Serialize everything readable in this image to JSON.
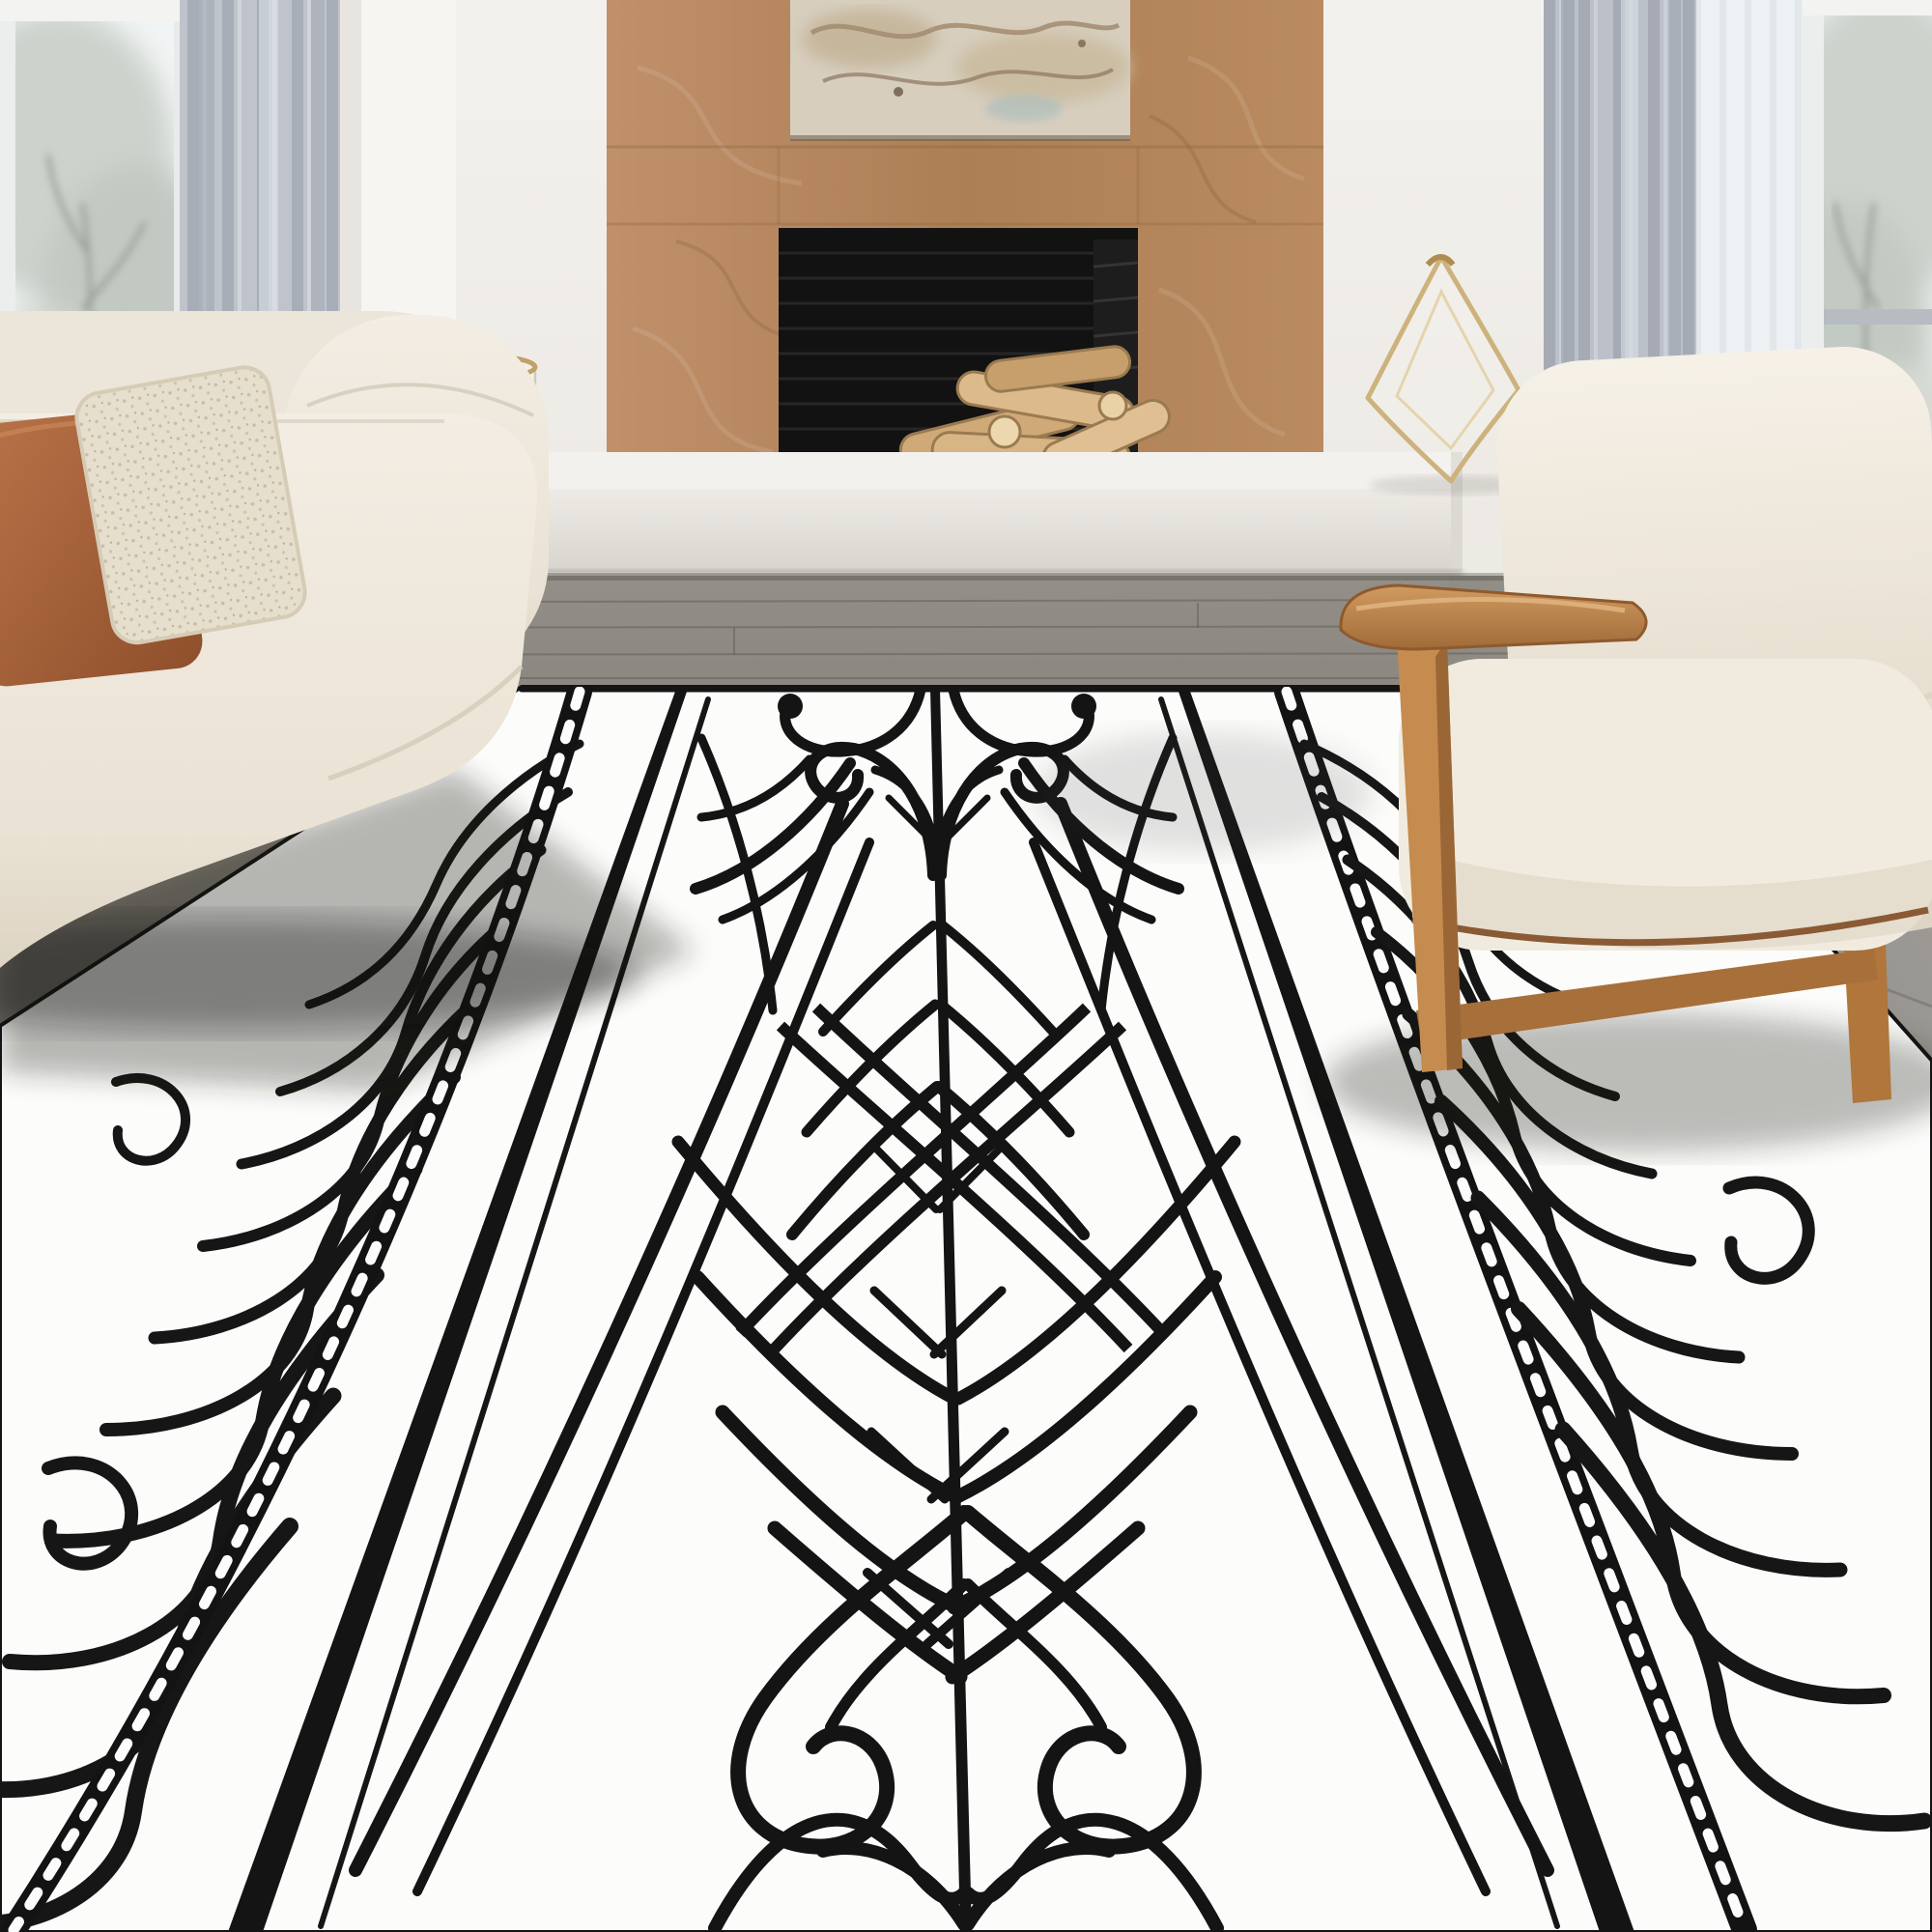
{
  "scene": {
    "type": "interior-photo",
    "setting": "Minimalist living room with fireplace; a large white rug with bold black tribal koru line-art pattern lies on a grey wood floor",
    "objects": {
      "wall": {
        "label": "warm white wall",
        "color": "#edeae4"
      },
      "left_window": {
        "label": "tall left window with winter trees outside",
        "glass": "#f1f4f4",
        "sash": "#b6bcc2"
      },
      "right_window": {
        "label": "tall right window with winter trees outside",
        "glass": "#f1f4f4",
        "sash": "#b6bcc2"
      },
      "left_curtain": {
        "label": "grey curtain panel left",
        "color": "#b9bfc7"
      },
      "right_curtain": {
        "label": "grey curtain panel right",
        "color": "#b9bfc7"
      },
      "right_sheer": {
        "label": "white sheer curtain",
        "color": "#ecf0f2"
      },
      "fireplace_surround": {
        "label": "oak wood fireplace surround",
        "color": "#b5875d"
      },
      "artwork": {
        "label": "abstract marble-toned artwork above mantel",
        "color": "#d7cebe"
      },
      "firebox": {
        "label": "black firebox with stacked birch logs on pebbles",
        "color": "#121212",
        "logs": "#d7b584"
      },
      "hearth_bench": {
        "label": "long white floating hearth bench",
        "color": "#eceae5"
      },
      "glass_hurricane": {
        "label": "glass hurricane vase with brass rim",
        "rim": "#c2a066"
      },
      "glass_sculpture": {
        "label": "clear diamond-shaped glass sculpture",
        "edge": "#cdb27c"
      },
      "floor": {
        "label": "grey wood plank floor",
        "color": "#87837c"
      },
      "rug": {
        "label": "white rug with black Maori-style koru line pattern, chain borders and central spine motif",
        "base": "#fcfcfb",
        "line": "#161616"
      },
      "sofa": {
        "label": "cream fabric sofa with rust and speckled pillows",
        "color": "#efe9df",
        "pillow_rust": "#b2693e",
        "pillow_cream": "#e7dfcd"
      },
      "armchair": {
        "label": "cream lounge armchair with oak wood frame",
        "cushion": "#f2ede2",
        "wood": "#c58b4f"
      }
    },
    "palette": {
      "wall": "#edeae4",
      "wood": "#b5875d",
      "floor": "#87837c",
      "rug_base": "#fcfcfb",
      "rug_line": "#161616",
      "sofa": "#efe9df",
      "rust": "#b2693e",
      "curtain": "#b9bfc7"
    }
  }
}
